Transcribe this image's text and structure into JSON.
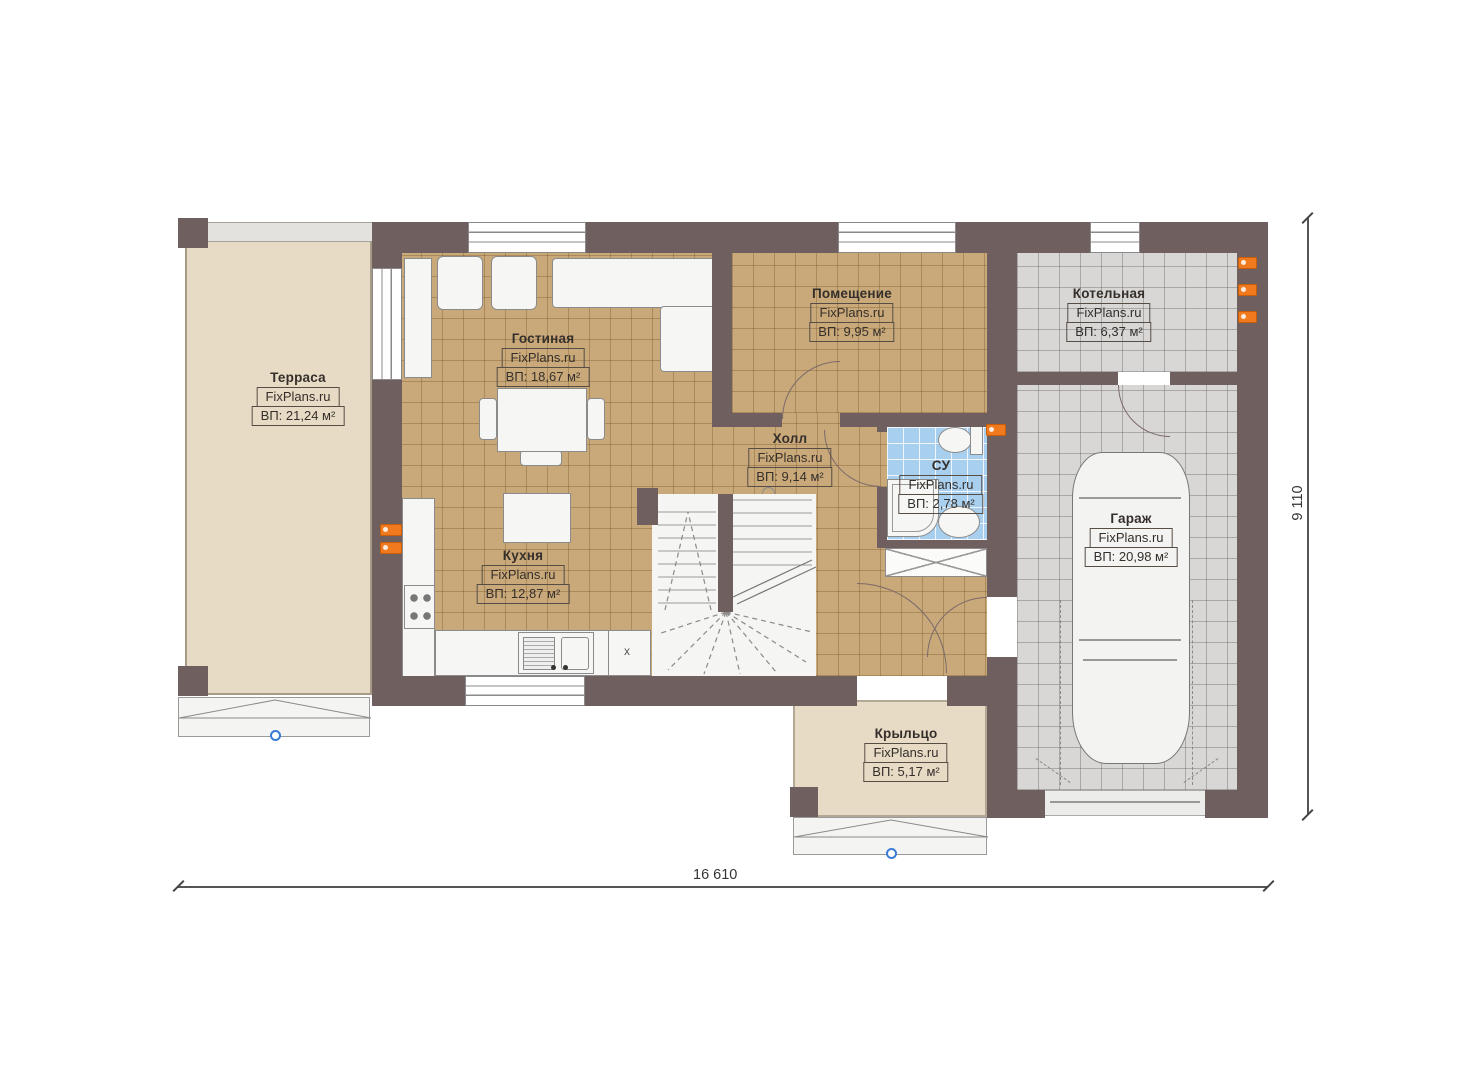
{
  "watermark": "FixPlans.ru",
  "rooms": [
    {
      "key": "terrace",
      "name": "Терраса",
      "area": "ВП: 21,24 м²"
    },
    {
      "key": "living",
      "name": "Гостиная",
      "area": "ВП: 18,67 м²"
    },
    {
      "key": "kitchen",
      "name": "Кухня",
      "area": "ВП: 12,87 м²"
    },
    {
      "key": "room",
      "name": "Помещение",
      "area": "ВП: 9,95 м²"
    },
    {
      "key": "boiler",
      "name": "Котельная",
      "area": "ВП: 6,37 м²"
    },
    {
      "key": "hall",
      "name": "Холл",
      "area": "ВП: 9,14 м²"
    },
    {
      "key": "wc",
      "name": "СУ",
      "area": "ВП: 2,78 м²"
    },
    {
      "key": "garage",
      "name": "Гараж",
      "area": "ВП: 20,98 м²"
    },
    {
      "key": "porch",
      "name": "Крыльцо",
      "area": "ВП: 5,17 м²"
    }
  ],
  "dimensions": {
    "horizontal": "16 610",
    "vertical": "9 110"
  },
  "marks": {
    "appliance_x": "x"
  },
  "colors": {
    "wall": "#6f5f5f",
    "floor_wood": "#c9a97a",
    "floor_tile_gray": "#d8d7d5",
    "floor_tile_blue": "#a9cfee",
    "terrace_floor": "#e8dbc5",
    "socket": "#f07a1d"
  }
}
